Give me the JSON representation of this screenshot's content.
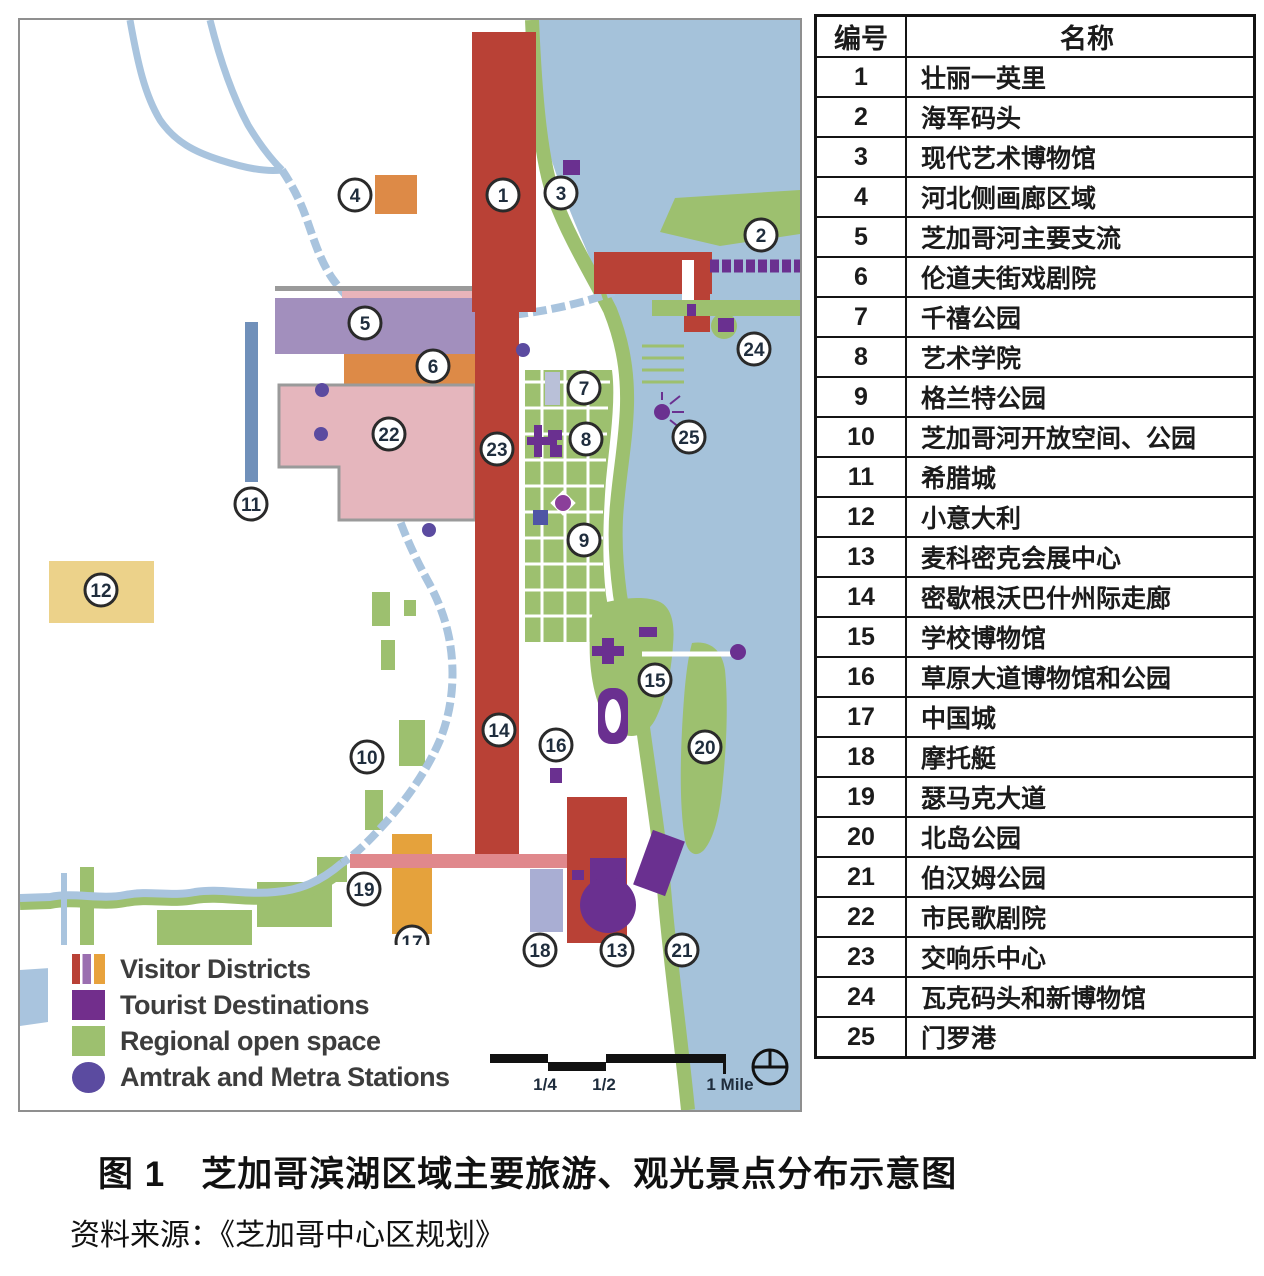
{
  "figure": {
    "caption": "图 1　芝加哥滨湖区域主要旅游、观光景点分布示意图",
    "source": "资料来源：《芝加哥中心区规划》"
  },
  "table": {
    "headers": [
      "编号",
      "名称"
    ],
    "rows": [
      [
        "1",
        "壮丽一英里"
      ],
      [
        "2",
        "海军码头"
      ],
      [
        "3",
        "现代艺术博物馆"
      ],
      [
        "4",
        "河北侧画廊区域"
      ],
      [
        "5",
        "芝加哥河主要支流"
      ],
      [
        "6",
        "伦道夫街戏剧院"
      ],
      [
        "7",
        "千禧公园"
      ],
      [
        "8",
        "艺术学院"
      ],
      [
        "9",
        "格兰特公园"
      ],
      [
        "10",
        "芝加哥河开放空间、公园"
      ],
      [
        "11",
        "希腊城"
      ],
      [
        "12",
        "小意大利"
      ],
      [
        "13",
        "麦科密克会展中心"
      ],
      [
        "14",
        "密歇根沃巴什州际走廊"
      ],
      [
        "15",
        "学校博物馆"
      ],
      [
        "16",
        "草原大道博物馆和公园"
      ],
      [
        "17",
        "中国城"
      ],
      [
        "18",
        "摩托艇"
      ],
      [
        "19",
        "瑟马克大道"
      ],
      [
        "20",
        "北岛公园"
      ],
      [
        "21",
        "伯汉姆公园"
      ],
      [
        "22",
        "市民歌剧院"
      ],
      [
        "23",
        "交响乐中心"
      ],
      [
        "24",
        "瓦克码头和新博物馆"
      ],
      [
        "25",
        "门罗港"
      ]
    ]
  },
  "map": {
    "legend": [
      {
        "label": "Visitor Districts",
        "swatch": "stripes"
      },
      {
        "label": "Tourist Destinations",
        "swatch": "purple"
      },
      {
        "label": "Regional open space",
        "swatch": "green"
      },
      {
        "label": "Amtrak and Metra Stations",
        "swatch": "dot"
      }
    ],
    "scale": {
      "quarter": "1/4",
      "half": "1/2",
      "mile": "1 Mile"
    },
    "markers": [
      {
        "n": "1",
        "x": 483,
        "y": 175
      },
      {
        "n": "2",
        "x": 741,
        "y": 215
      },
      {
        "n": "3",
        "x": 541,
        "y": 173
      },
      {
        "n": "4",
        "x": 335,
        "y": 175
      },
      {
        "n": "5",
        "x": 345,
        "y": 303
      },
      {
        "n": "6",
        "x": 413,
        "y": 346
      },
      {
        "n": "7",
        "x": 564,
        "y": 368
      },
      {
        "n": "8",
        "x": 566,
        "y": 419
      },
      {
        "n": "9",
        "x": 564,
        "y": 520
      },
      {
        "n": "10",
        "x": 347,
        "y": 737
      },
      {
        "n": "11",
        "x": 231,
        "y": 484
      },
      {
        "n": "12",
        "x": 81,
        "y": 570
      },
      {
        "n": "13",
        "x": 597,
        "y": 930
      },
      {
        "n": "14",
        "x": 479,
        "y": 710
      },
      {
        "n": "15",
        "x": 635,
        "y": 660
      },
      {
        "n": "16",
        "x": 536,
        "y": 725
      },
      {
        "n": "17",
        "x": 392,
        "y": 922
      },
      {
        "n": "18",
        "x": 520,
        "y": 930
      },
      {
        "n": "19",
        "x": 344,
        "y": 869
      },
      {
        "n": "20",
        "x": 685,
        "y": 727
      },
      {
        "n": "21",
        "x": 662,
        "y": 930
      },
      {
        "n": "22",
        "x": 369,
        "y": 414
      },
      {
        "n": "23",
        "x": 477,
        "y": 429
      },
      {
        "n": "24",
        "x": 734,
        "y": 329
      },
      {
        "n": "25",
        "x": 669,
        "y": 417
      }
    ],
    "colors": {
      "visitor_red": "#b94136",
      "district_purple": "#a28fbd",
      "open_green": "#9dc06f",
      "tourist_purple": "#6a3090",
      "station_purple": "#5b4ba0",
      "lake_blue": "#a5c2da",
      "river_blue": "#a9c4de",
      "pink_block": "#e5b6bd",
      "orange_block": "#dd8a47",
      "yellow_block": "#ecd28a",
      "salmon_bar": "#e0888c",
      "lavender_block": "#a9aed3"
    }
  }
}
